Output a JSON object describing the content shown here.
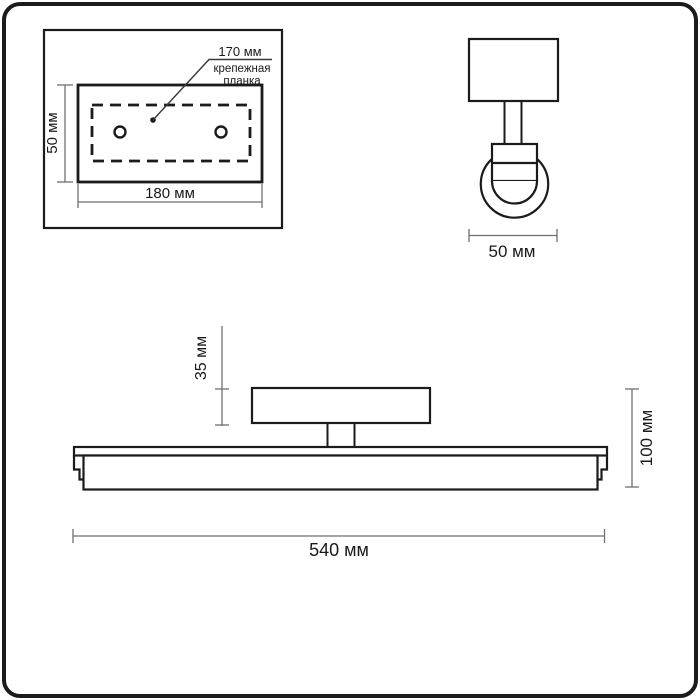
{
  "units": "мм",
  "colors": {
    "line": "#1b1b1b",
    "dim_line": "#6f6f6f",
    "background": "#ffffff",
    "text": "#1a1a1a"
  },
  "plate_view": {
    "holes_distance_label": "170 мм",
    "bracket_label_line1": "крепежная",
    "bracket_label_line2": "планка",
    "height_label": "50 мм",
    "width_label": "180 мм",
    "holes_distance_mm": 170,
    "width_mm": 180,
    "height_mm": 50
  },
  "side_view": {
    "width_label": "50 мм",
    "width_mm": 50
  },
  "front_view": {
    "plate_height_label": "35 мм",
    "total_height_label": "100 мм",
    "total_width_label": "540 мм",
    "plate_height_mm": 35,
    "total_height_mm": 100,
    "total_width_mm": 540
  }
}
